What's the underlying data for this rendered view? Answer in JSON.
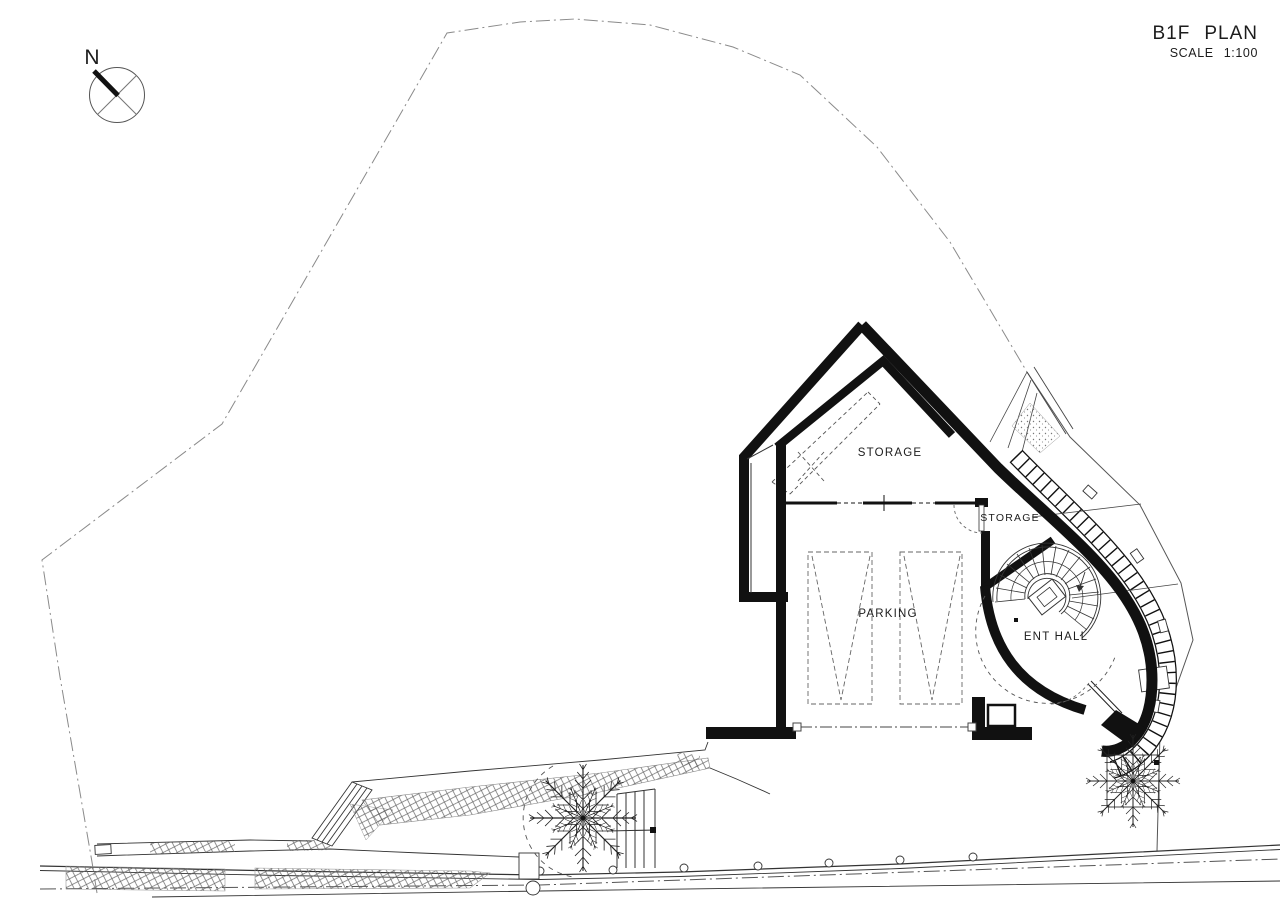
{
  "title_block": {
    "title": "B1F PLAN",
    "title_parts": [
      "B1F",
      "PLAN"
    ],
    "scale_label": "SCALE",
    "scale_value": "1:100"
  },
  "compass": {
    "north_label": "N"
  },
  "rooms": {
    "storage_main": "STORAGE",
    "storage_small": "STORAGE",
    "parking": "PARKING",
    "ent_hall": "ENT HALL"
  },
  "drawing": {
    "type": "architectural basement floor plan",
    "features": [
      "site boundary",
      "parking bays",
      "spiral staircase",
      "entrance hall",
      "storage rooms",
      "trees",
      "exterior stairs",
      "road"
    ]
  },
  "colors": {
    "paper": "#ffffff",
    "wall_ink": "#111111",
    "line_ink": "#333333",
    "faint_ink": "#8a8a8a",
    "label_ink": "#1c1c1c"
  }
}
